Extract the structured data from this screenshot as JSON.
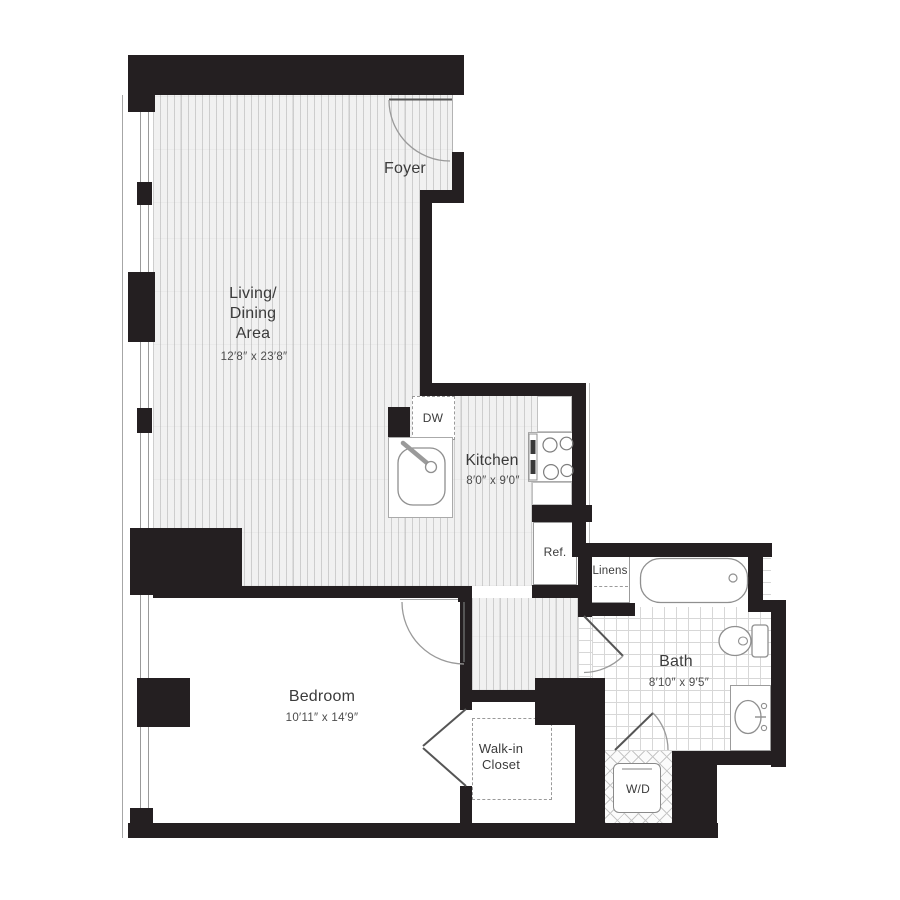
{
  "floorplan": {
    "colors": {
      "wall": "#241f21",
      "fixture_outline": "#8f8f8f",
      "room_text": "#3b3b3b",
      "dim_text": "#4c4c4c"
    },
    "rooms": {
      "foyer": {
        "label": "Foyer"
      },
      "living": {
        "label": "Living/\nDining\nArea",
        "dims": "12′8″ x 23′8″"
      },
      "kitchen": {
        "label": "Kitchen",
        "dims": "8′0″ x 9′0″"
      },
      "bedroom": {
        "label": "Bedroom",
        "dims": "10′11″ x 14′9″"
      },
      "bath": {
        "label": "Bath",
        "dims": "8′10″ x 9′5″"
      },
      "walkin_closet": {
        "label": "Walk-in\nCloset"
      }
    },
    "labels": {
      "dishwasher": "DW",
      "refrigerator": "Ref.",
      "linens": "Linens",
      "washer_dryer": "W/D"
    }
  }
}
